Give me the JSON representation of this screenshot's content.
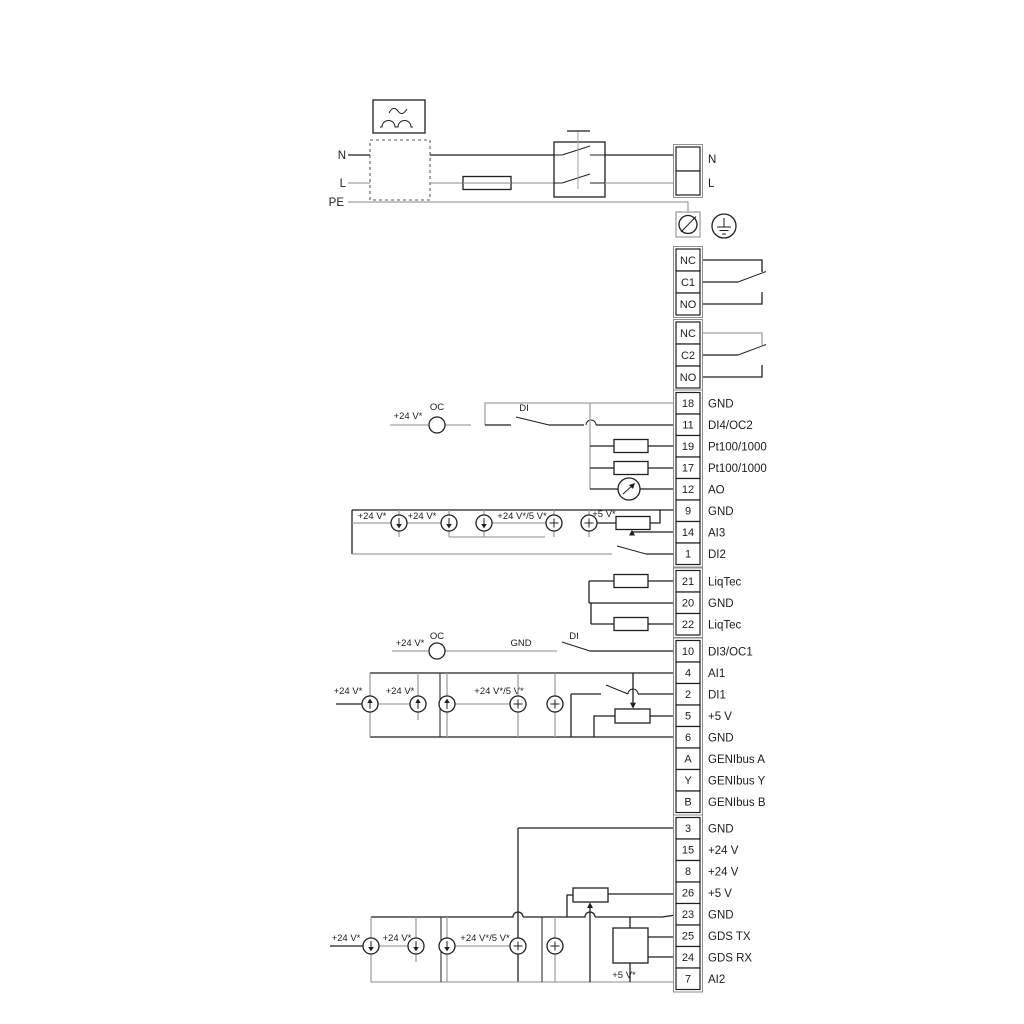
{
  "power": {
    "left_labels": {
      "n": "N",
      "l": "L",
      "pe": "PE"
    },
    "right_labels": [
      "N",
      "L"
    ]
  },
  "relay1": {
    "rows": [
      "NC",
      "C1",
      "NO"
    ]
  },
  "relay2": {
    "rows": [
      "NC",
      "C2",
      "NO"
    ]
  },
  "io1": {
    "rows": [
      [
        "18",
        "GND"
      ],
      [
        "11",
        "DI4/OC2"
      ],
      [
        "19",
        "Pt100/1000"
      ],
      [
        "17",
        "Pt100/1000"
      ],
      [
        "12",
        "AO"
      ],
      [
        "9",
        "GND"
      ],
      [
        "14",
        "AI3"
      ],
      [
        "1",
        "DI2"
      ]
    ]
  },
  "liqtec": {
    "rows": [
      [
        "21",
        "LiqTec"
      ],
      [
        "20",
        "GND"
      ],
      [
        "22",
        "LiqTec"
      ]
    ]
  },
  "io2": {
    "rows": [
      [
        "10",
        "DI3/OC1"
      ],
      [
        "4",
        "AI1"
      ],
      [
        "2",
        "DI1"
      ],
      [
        "5",
        "+5 V"
      ],
      [
        "6",
        "GND"
      ],
      [
        "A",
        "GENIbus A"
      ],
      [
        "Y",
        "GENIbus Y"
      ],
      [
        "B",
        "GENIbus B"
      ]
    ]
  },
  "io3": {
    "rows": [
      [
        "3",
        "GND"
      ],
      [
        "15",
        "+24 V"
      ],
      [
        "8",
        "+24 V"
      ],
      [
        "26",
        "+5 V"
      ],
      [
        "23",
        "GND"
      ],
      [
        "25",
        "GDS TX"
      ],
      [
        "24",
        "GDS RX"
      ],
      [
        "7",
        "AI2"
      ]
    ]
  },
  "ann": {
    "di4": {
      "v24": "+24 V*",
      "oc": "OC",
      "di": "DI"
    },
    "ai3": {
      "v24a": "+24 V*",
      "v24b": "+24 V*",
      "v245": "+24 V*/5 V*",
      "v5": "+5 V*"
    },
    "di3": {
      "v24": "+24 V*",
      "oc": "OC",
      "gnd": "GND",
      "di": "DI"
    },
    "ai1": {
      "v24a": "+24 V*",
      "v24b": "+24 V*",
      "v245": "+24 V*/5 V*"
    },
    "ai2": {
      "v24a": "+24 V*",
      "v24b": "+24 V*",
      "v245": "+24 V*/5 V*",
      "v5": "+5 V*"
    }
  },
  "colors": {
    "wire_dark": "#1f1f1f",
    "wire_gray": "#a0a0a0",
    "outer_border": "#8f8f8f"
  }
}
